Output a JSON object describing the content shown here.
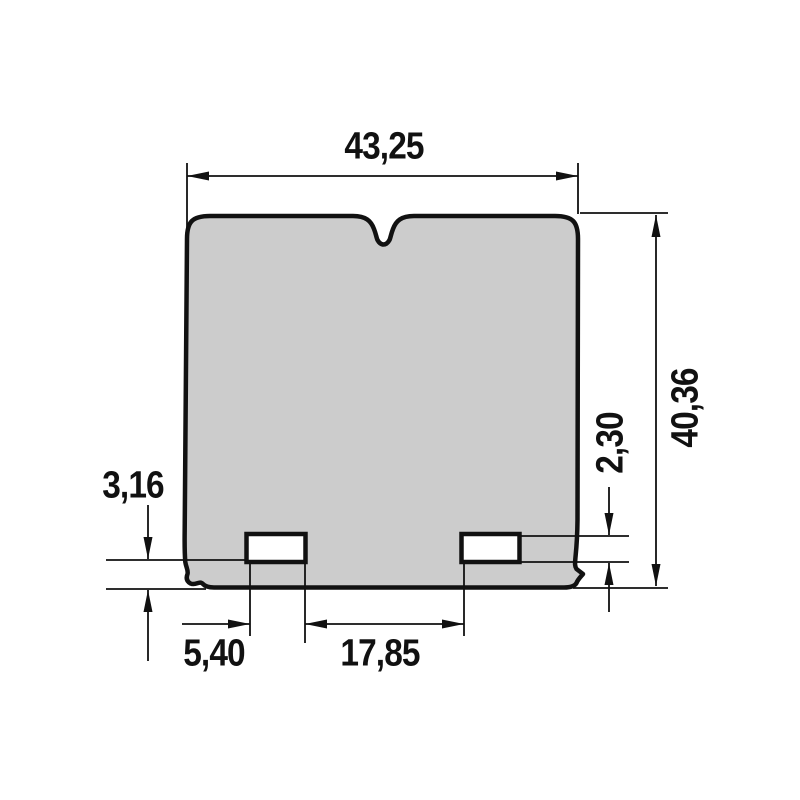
{
  "drawing": {
    "kind": "technical-dimension-drawing",
    "part": "reed-petal-outline-with-two-slots",
    "dimensions": {
      "overall_width": "43,25",
      "overall_height": "40,36",
      "slot_height": "2,30",
      "bottom_edge_to_slot": "3,16",
      "slot_width": "5,40",
      "slot_gap": "17,85"
    },
    "colors": {
      "line": "#111111",
      "part_fill": "#cccccc",
      "background": "#ffffff"
    }
  }
}
